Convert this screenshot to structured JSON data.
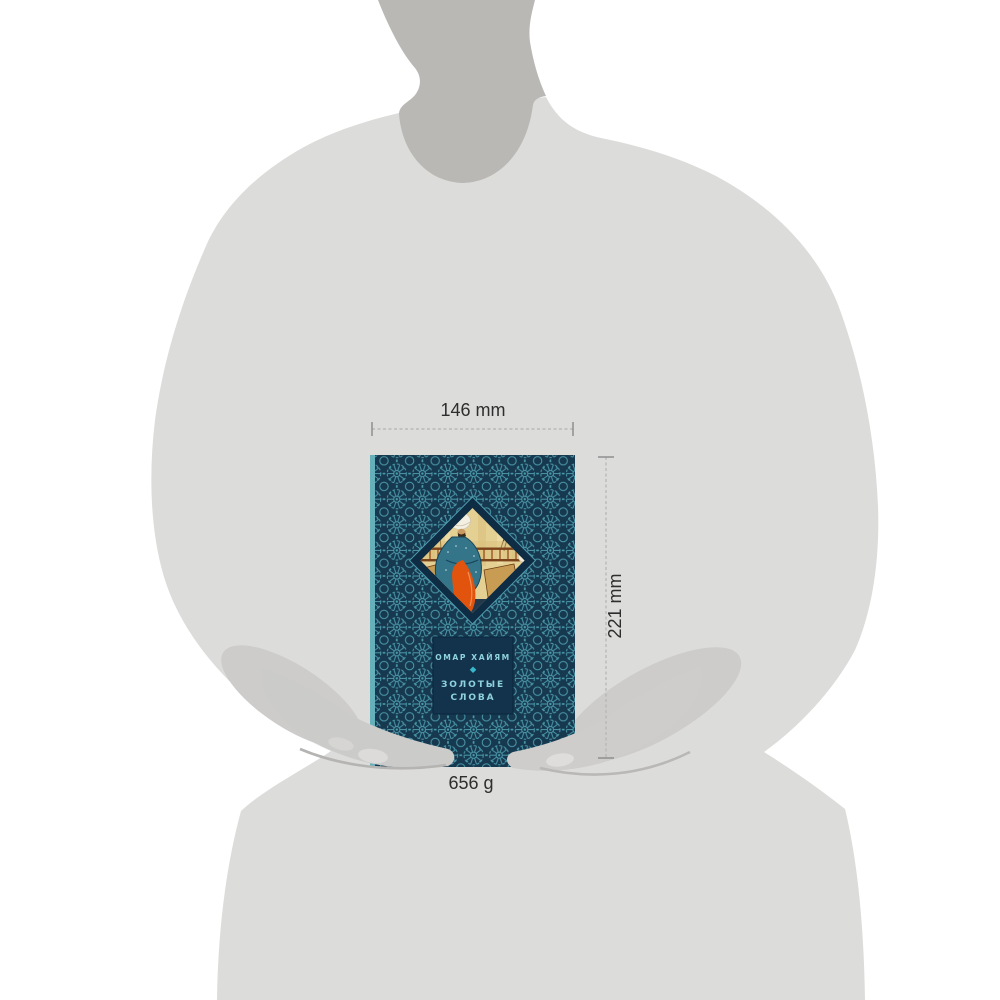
{
  "scene": {
    "description": "product-dimensions-visualization",
    "background_color": "#ffffff"
  },
  "annotations": {
    "width_label": "146 mm",
    "height_label": "221 mm",
    "weight_label": "656 g",
    "text_color": "#2e2e2e",
    "line_color": "#b3b3b3",
    "tick_color": "#8a8a8a"
  },
  "silhouette": {
    "body_color": "#dcdcda",
    "neck_color": "#b9b8b5",
    "sleeve_color": "#cdccca",
    "hand_color": "#cbcbc9",
    "hand_highlight_color": "#dcdbd9",
    "hand_shadow_color": "#b5b4b2"
  },
  "book": {
    "author": "ОМАР ХАЙЯМ",
    "divider_glyph": "◆",
    "title_line1": "ЗОЛОТЫЕ",
    "title_line2": "СЛОВА",
    "colors": {
      "cover_base": "#16394f",
      "pattern_line": "#4d9aac",
      "spine_edge": "#66b0bc",
      "diamond_frame": "#0e2c44",
      "label_bg": "#12334b",
      "label_text": "#8ed2dd",
      "accent": "#37b7ca"
    }
  }
}
